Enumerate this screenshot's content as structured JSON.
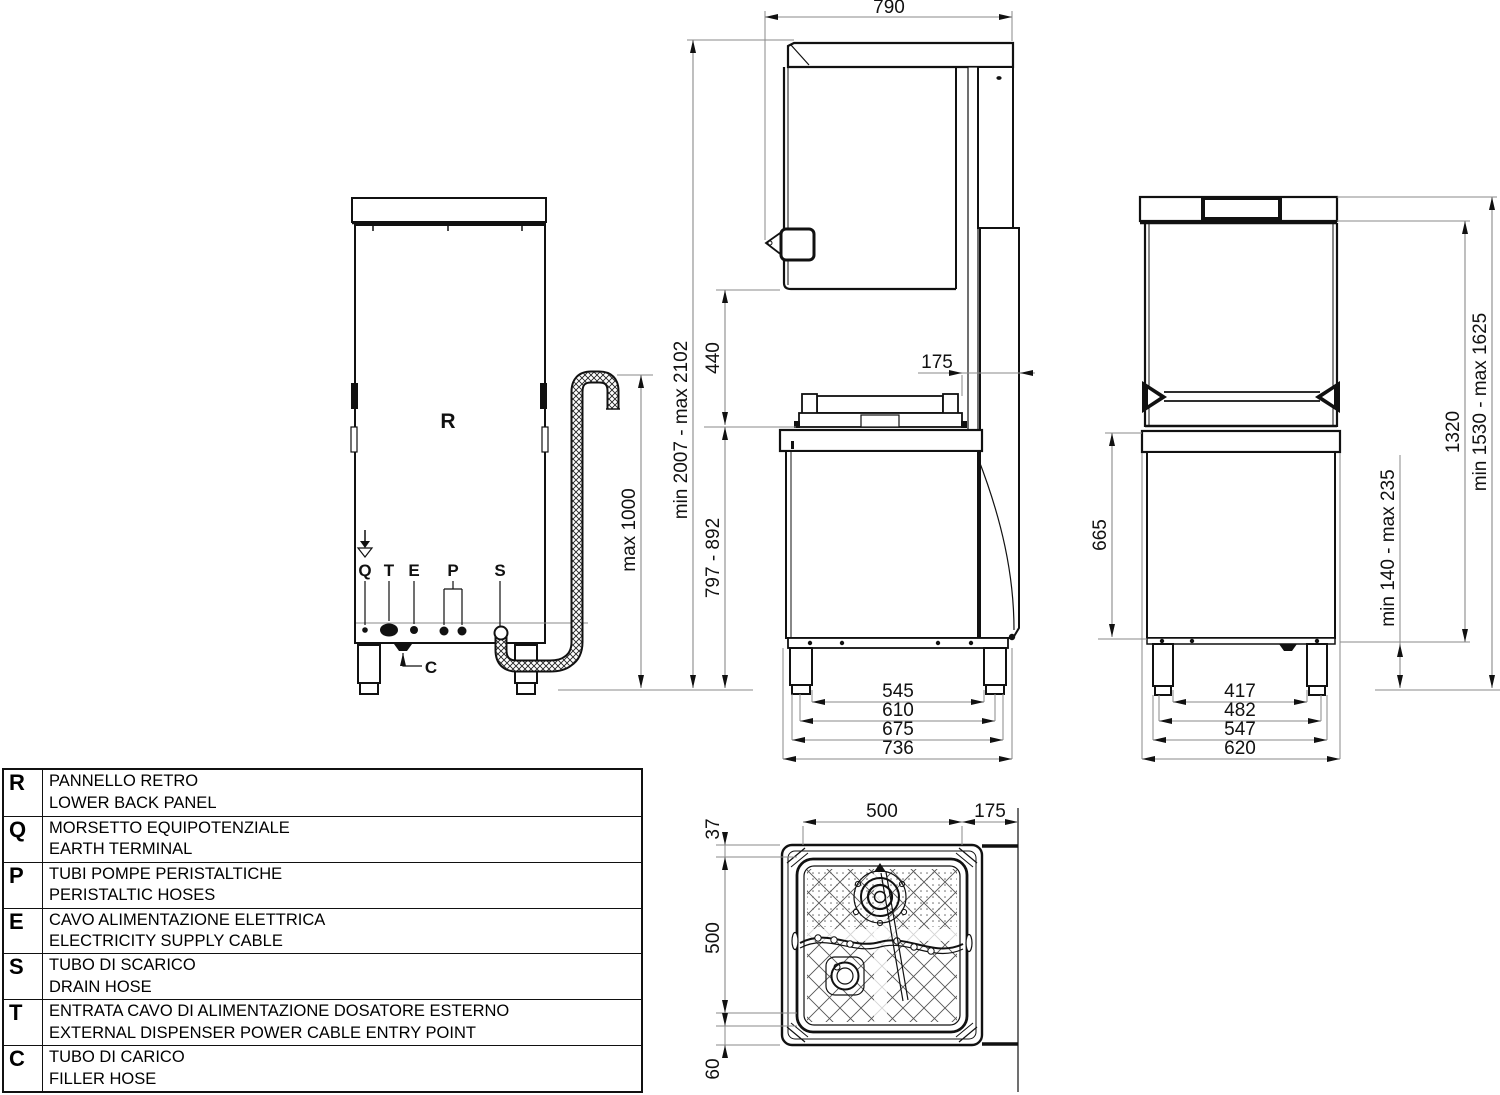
{
  "legend": {
    "rows": [
      {
        "key": "R",
        "line1": "PANNELLO RETRO",
        "line2": "LOWER BACK PANEL"
      },
      {
        "key": "Q",
        "line1": "MORSETTO EQUIPOTENZIALE",
        "line2": "EARTH TERMINAL"
      },
      {
        "key": "P",
        "line1": "TUBI POMPE PERISTALTICHE",
        "line2": "PERISTALTIC HOSES"
      },
      {
        "key": "E",
        "line1": "CAVO ALIMENTAZIONE ELETTRICA",
        "line2": "ELECTRICITY SUPPLY CABLE"
      },
      {
        "key": "S",
        "line1": "TUBO DI SCARICO",
        "line2": "DRAIN HOSE"
      },
      {
        "key": "T",
        "line1": "ENTRATA CAVO DI ALIMENTAZIONE DOSATORE ESTERNO",
        "line2": "EXTERNAL DISPENSER POWER CABLE ENTRY POINT"
      },
      {
        "key": "C",
        "line1": "TUBO DI CARICO",
        "line2": "FILLER HOSE"
      }
    ]
  },
  "back_view": {
    "label_r": "R",
    "label_q": "Q",
    "label_t": "T",
    "label_e": "E",
    "label_p": "P",
    "label_s": "S",
    "label_c": "C",
    "dim_hose": "max 1000"
  },
  "side_view": {
    "dim_depth": "790",
    "dim_total": "min 2007 - max 2102",
    "dim_clearance": "440",
    "dim_rear": "175",
    "dim_worktop": "797 - 892",
    "dim_b1": "545",
    "dim_b2": "610",
    "dim_b3": "675",
    "dim_b4": "736"
  },
  "front_view": {
    "dim_total": "min 1530 - max 1625",
    "dim_upper": "1320",
    "dim_body": "665",
    "dim_legs": "min 140 - max 235",
    "dim_b1": "417",
    "dim_b2": "482",
    "dim_b3": "547",
    "dim_b4": "620"
  },
  "top_view": {
    "dim_width": "500",
    "dim_rear": "175",
    "dim_front": "37",
    "dim_depth": "500",
    "dim_back": "60"
  }
}
